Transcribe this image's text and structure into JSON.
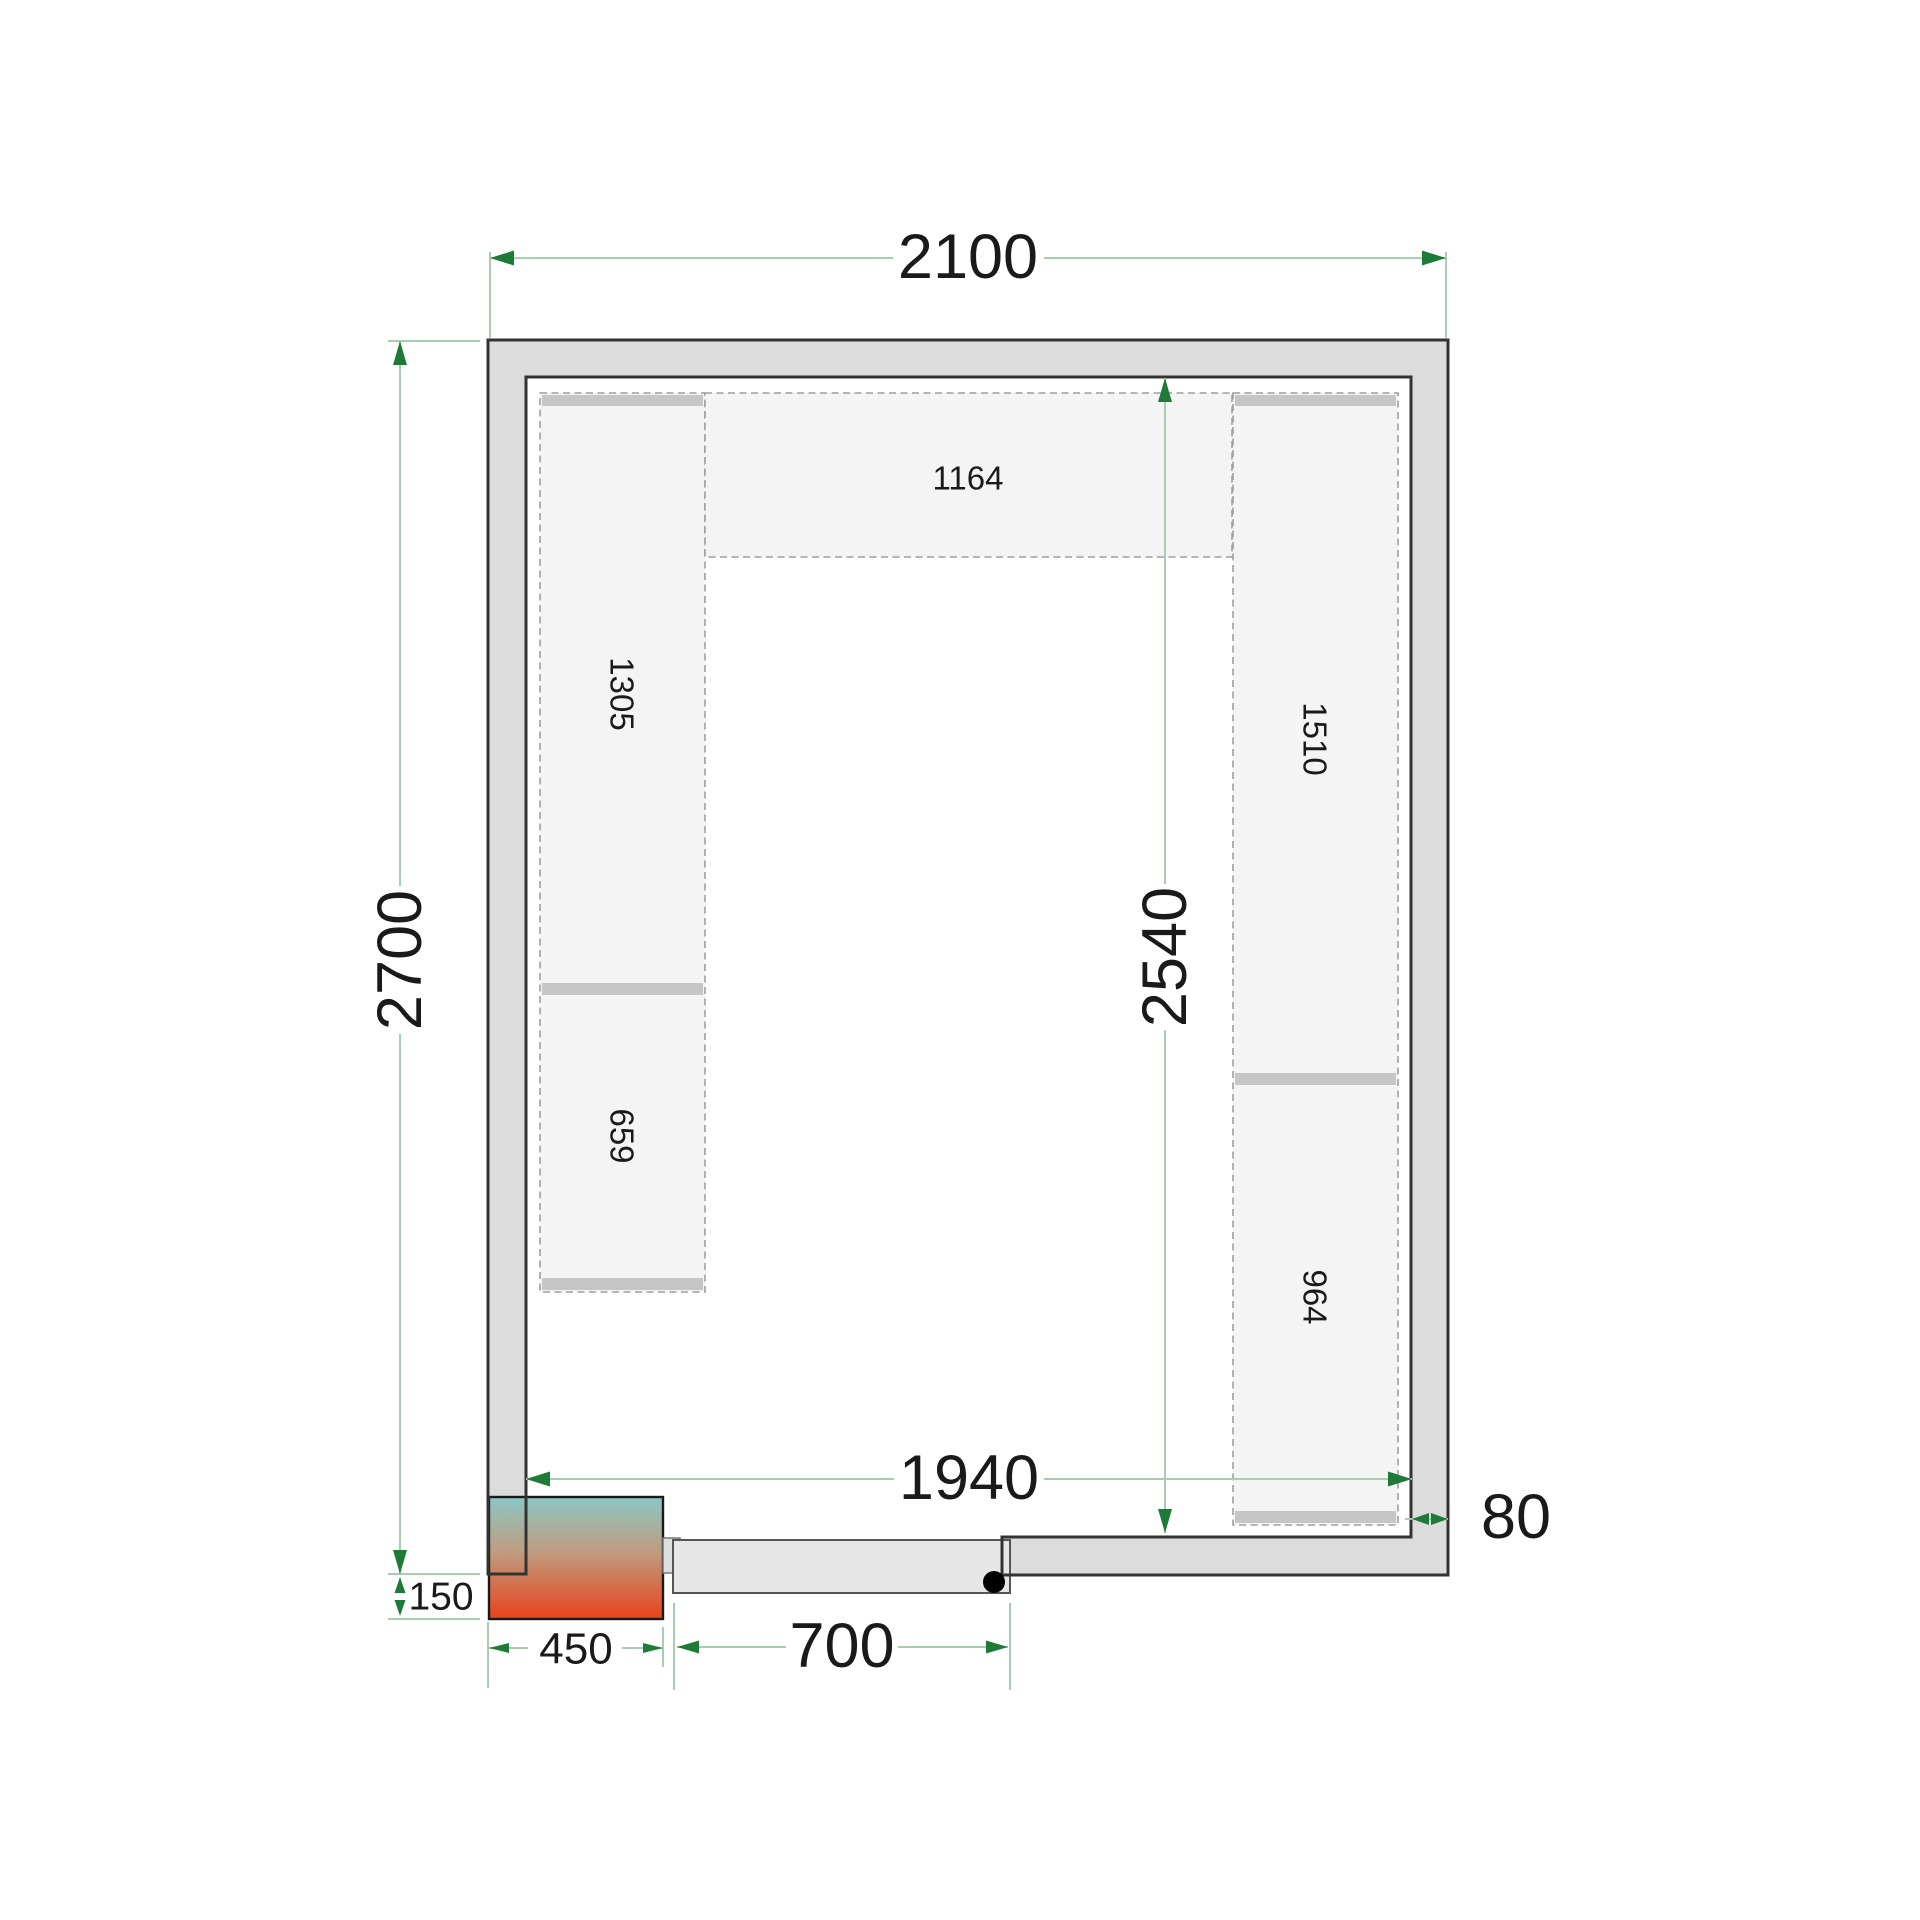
{
  "drawing": {
    "type": "cold-room-floor-plan",
    "dimensions": {
      "outer_width": "2100",
      "outer_height": "2700",
      "inner_width": "1940",
      "inner_height": "2540",
      "wall_thickness": "80",
      "door_width": "700",
      "unit_width": "450",
      "unit_offset": "150"
    },
    "shelves": {
      "top": "1164",
      "left_upper": "1305",
      "left_lower": "659",
      "right_upper": "1510",
      "right_lower": "964"
    },
    "colors": {
      "background": "#ffffff",
      "wall_fill": "#dcdcdc",
      "wall_stroke": "#333333",
      "shelf_fill": "#f4f4f4",
      "shelf_dash": "#9f9f9f",
      "shelf_bar": "#c6c6c6",
      "door_fill": "#e6e6e6",
      "door_stroke": "#555555",
      "tab_fill": "#dedede",
      "tab_stroke": "#777777",
      "unit_top": "#8cc7c4",
      "unit_mid": "#bf9c80",
      "unit_bottom": "#e8431a",
      "unit_stroke": "#1a1a1a",
      "dim_line": "#a9cdb2",
      "dim_arrow": "#1d7b37",
      "text": "#1a1a1a",
      "pivot_dot": "#000000"
    }
  }
}
